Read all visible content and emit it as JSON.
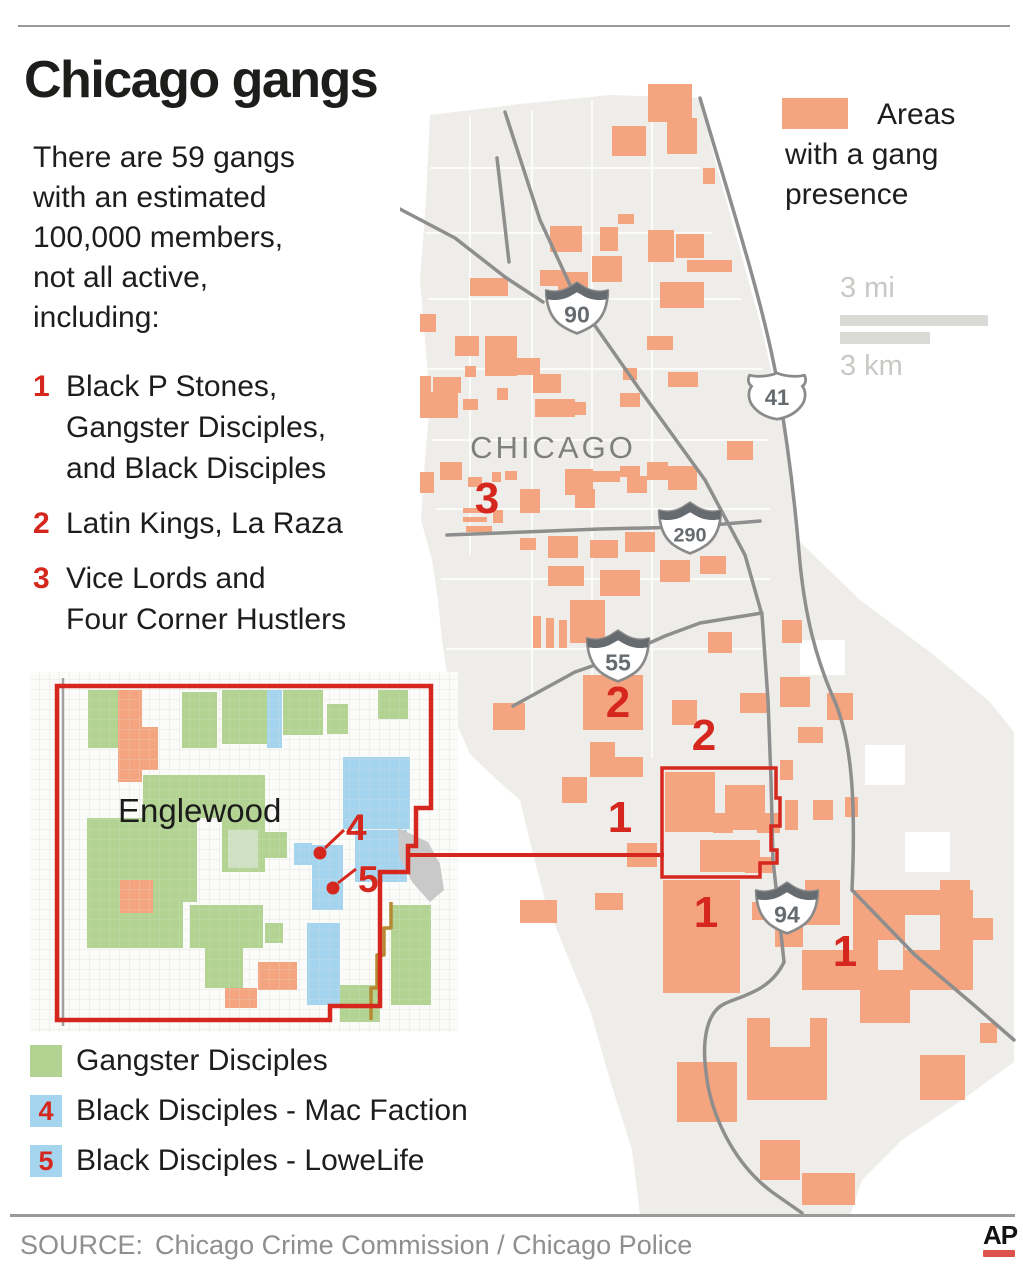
{
  "colors": {
    "gang_area_orange": "#f4a47e",
    "accent_red": "#d5271d",
    "gd_green": "#b2d392",
    "pale_green": "#cfe0c3",
    "bd_blue": "#a5d4ee",
    "city_fill": "#efedea",
    "road_gray": "#8e8e8e",
    "shield_gray": "#666b70",
    "label_gray": "#7f7f7f",
    "text_dark": "#1d1d1b",
    "muted_gray": "#8f8f8f",
    "scale_gray": "#c8c8c5",
    "scale_bar": "#dadad6",
    "olive": "#b68a33",
    "rule_gray": "#9a9a9a",
    "rail_gray": "#c9c9c9"
  },
  "header": {
    "title": "Chicago gangs",
    "intro": "There are 59 gangs\nwith an estimated\n100,000 members,\nnot all active,\nincluding:"
  },
  "gang_list": [
    {
      "num": "1",
      "label": "Black P Stones,\nGangster Disciples,\nand Black Disciples"
    },
    {
      "num": "2",
      "label": "Latin Kings, La Raza"
    },
    {
      "num": "3",
      "label": "Vice Lords and\nFour Corner Hustlers"
    }
  ],
  "map_legend": {
    "label": "Areas\nwith a gang\npresence"
  },
  "scale": {
    "mi": "3 mi",
    "km": "3 km"
  },
  "map": {
    "city_label": "CHICAGO",
    "shields": [
      {
        "type": "interstate",
        "num": "90"
      },
      {
        "type": "us",
        "num": "41"
      },
      {
        "type": "interstate",
        "num": "290"
      },
      {
        "type": "interstate",
        "num": "55"
      },
      {
        "type": "interstate",
        "num": "94"
      }
    ],
    "area_markers": [
      {
        "num": "3"
      },
      {
        "num": "2"
      },
      {
        "num": "2"
      },
      {
        "num": "1"
      },
      {
        "num": "1"
      },
      {
        "num": "1"
      }
    ]
  },
  "inset": {
    "label": "Englewood",
    "markers": [
      {
        "num": "4"
      },
      {
        "num": "5"
      }
    ]
  },
  "bottom_legend": [
    {
      "num": "",
      "label": "Gangster Disciples"
    },
    {
      "num": "4",
      "label": "Black Disciples - Mac Faction"
    },
    {
      "num": "5",
      "label": "Black Disciples - LoweLife"
    }
  ],
  "footer": {
    "source_prefix": "SOURCE:",
    "source_text": "Chicago Crime Commission / Chicago Police",
    "credit": "AP"
  }
}
